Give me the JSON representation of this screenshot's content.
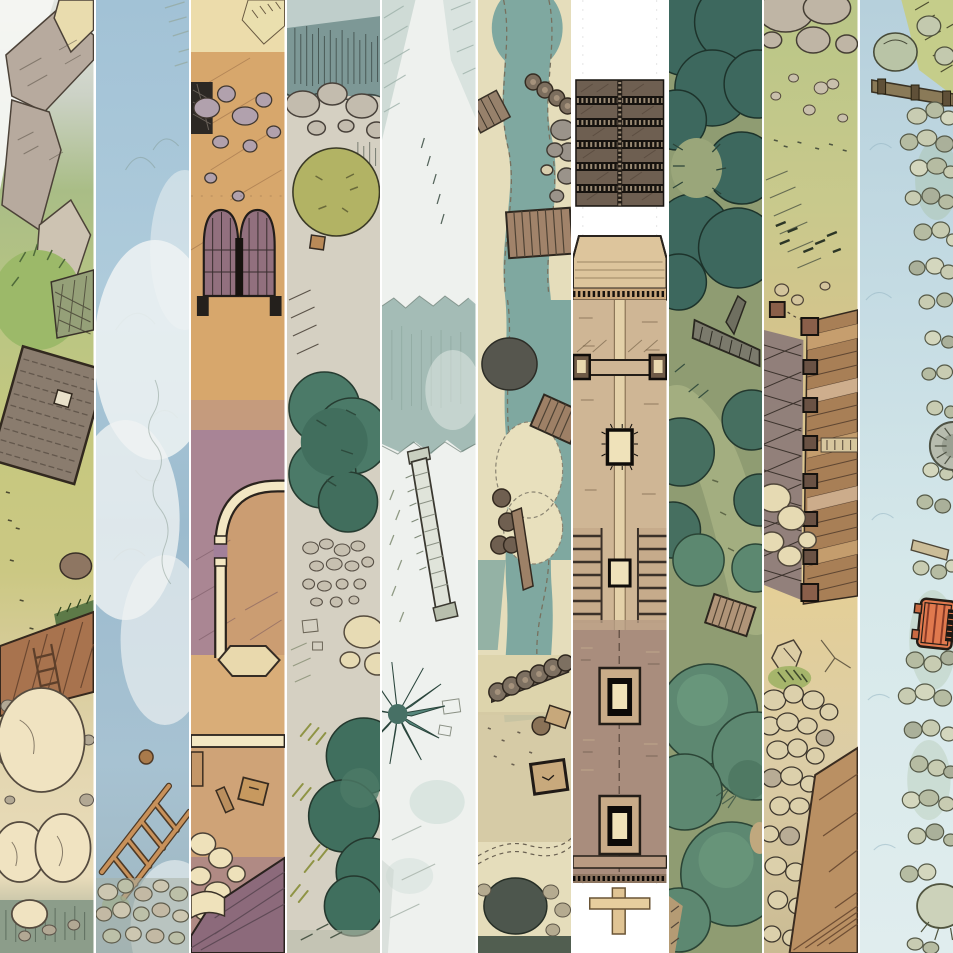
{
  "page": {
    "kind": "battle-map-strip-collage",
    "background": "#ffffff",
    "divider_color": "#ffffff",
    "strip_count": 10
  },
  "collage": {
    "strips": [
      {
        "index": 1,
        "name": "rock-slabs-meadow-hut",
        "description": "Grey rock slabs over a green meadow with a grey shingled hut roof, a wooden deck with ladder, large pale boulders and grey water at the bottom",
        "palette": [
          "#b7aa9e",
          "#aebd86",
          "#8a7c6e",
          "#a8734e",
          "#f0e3c1",
          "#8c9d8a"
        ]
      },
      {
        "index": 2,
        "name": "misty-blue-water",
        "description": "Pale blue watercolor water under drifting white mist, a fallen wooden ladder, a small brown float and a pebble shore at the bottom",
        "palette": [
          "#a2c2d6",
          "#eff3f3",
          "#c8915a",
          "#cdc7b1"
        ]
      },
      {
        "index": 3,
        "name": "courtyard-gate",
        "description": "Sandy courtyard with scattered grey rocks, an arched double wooden gate, a curved cream wall with hexagonal pad, crates, pale boulders and a mauve shingled roof corner",
        "palette": [
          "#d7a76c",
          "#a2809a",
          "#92707e",
          "#f3e7c3",
          "#8c6a7b"
        ]
      },
      {
        "index": 4,
        "name": "cliff-and-evergreens",
        "description": "Teal cliff edge with hatching and boulders, an olive bush, two dark evergreen canopies, pebbles and pale rocky ground",
        "palette": [
          "#7d9896",
          "#b2b364",
          "#4b7a68",
          "#d5d0c2"
        ]
      },
      {
        "index": 5,
        "name": "icy-stream-walkway",
        "description": "White icy wash with pale teal bands, a ragged teal stream, a long light plank walkway crossing diagonally and a spiky teal fern",
        "palette": [
          "#eef1ee",
          "#a4bcb6",
          "#e0e4da",
          "#55867b"
        ]
      },
      {
        "index": 6,
        "name": "river-crossings",
        "description": "Winding teal river between sandy pebble-edged banks with plank bridges, log piles, a dock, a small hut, a wheelbarrow and two dark ponds",
        "palette": [
          "#e5ddbb",
          "#7fa8a0",
          "#a1836a",
          "#56564e",
          "#c8a97c"
        ]
      },
      {
        "index": 7,
        "name": "long-wooden-pier",
        "description": "Top-down wooden pier on white: dark slatted rope bridge, tan gatehouse roof with stitched edge, cross beam with end posts, twin stairs, square hatch frames and a T-shaped mooring post",
        "palette": [
          "#ffffff",
          "#6e5f51",
          "#cfb695",
          "#a98d7d",
          "#efe2ba"
        ]
      },
      {
        "index": 8,
        "name": "dense-forest-trail",
        "description": "Dense dark-teal forest canopies with a fallen log, a light olive trail winding through and a small plank footbridge among rounded green treetops",
        "palette": [
          "#8f9c72",
          "#3d685e",
          "#a3ae80",
          "#5d8871"
        ]
      },
      {
        "index": 9,
        "name": "palisade-rampart",
        "description": "Grassy boulder-strewn slope above a planked palisade rampart with dark post caps and lattice netting, cream boulders, sandy ground, rock rubble and a diagonal plank deck",
        "palette": [
          "#b9c687",
          "#d2b494",
          "#9a8488",
          "#dcd0ab",
          "#ba9063"
        ]
      },
      {
        "index": 10,
        "name": "stony-shore-cart",
        "description": "Pale blue shallows along a pebbled stone shore with grass tufts, a timber beam, a stone ring, plank debris and a bright orange slatted hand cart",
        "palette": [
          "#b6d0dc",
          "#c8ccb2",
          "#e0794e",
          "#b7bcae"
        ]
      }
    ]
  }
}
